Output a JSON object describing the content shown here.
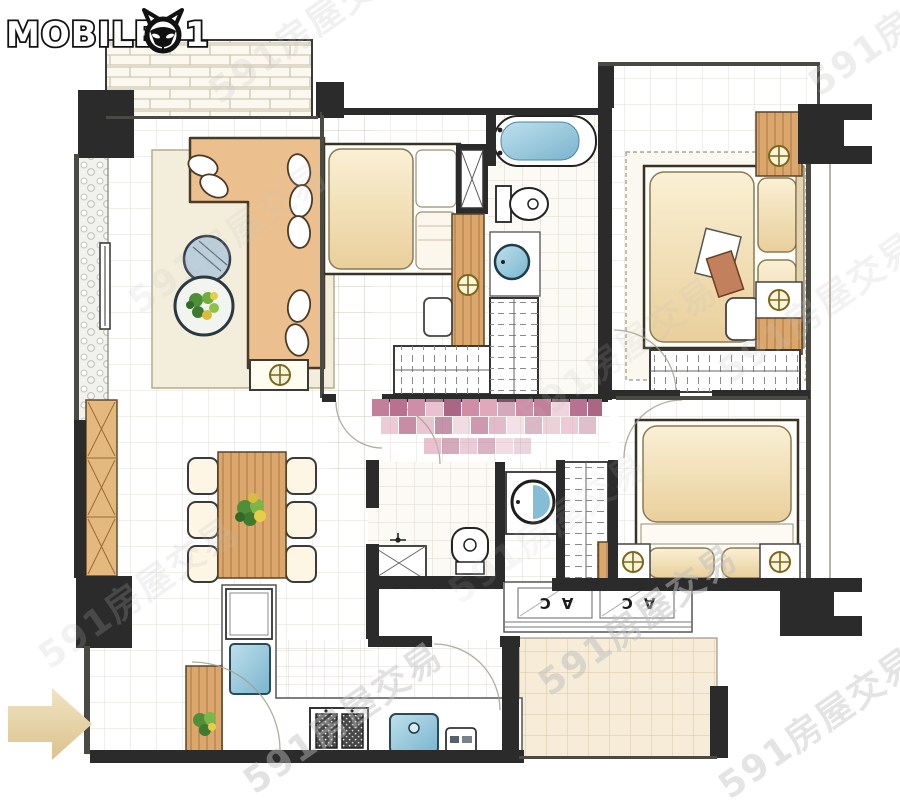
{
  "logo": {
    "brand_prefix": "MOBILE",
    "zero_icon": "cat-face-icon",
    "brand_suffix": "1"
  },
  "watermark": {
    "text": "591房屋交易"
  },
  "floor_plan": {
    "ac_units": [
      "AC",
      "AC"
    ],
    "censored_block": {
      "type": "pixelated-mosaic",
      "colors": [
        "#cf8da6",
        "#b8718e",
        "#dfa8bb",
        "#c27f9a",
        "#a96784"
      ]
    },
    "entrance_arrow_direction": "right"
  },
  "palette": {
    "wall": "#2b2b2b",
    "wood": "#dca76c",
    "wood_dark": "#5a4326",
    "cream": "#f6e6c0",
    "water": "#8ec3d8",
    "rug": "#f3eedb",
    "arrow": "#e9d8b0",
    "watermark_color": "#c0c0c0",
    "pink": "#cf8da6"
  }
}
